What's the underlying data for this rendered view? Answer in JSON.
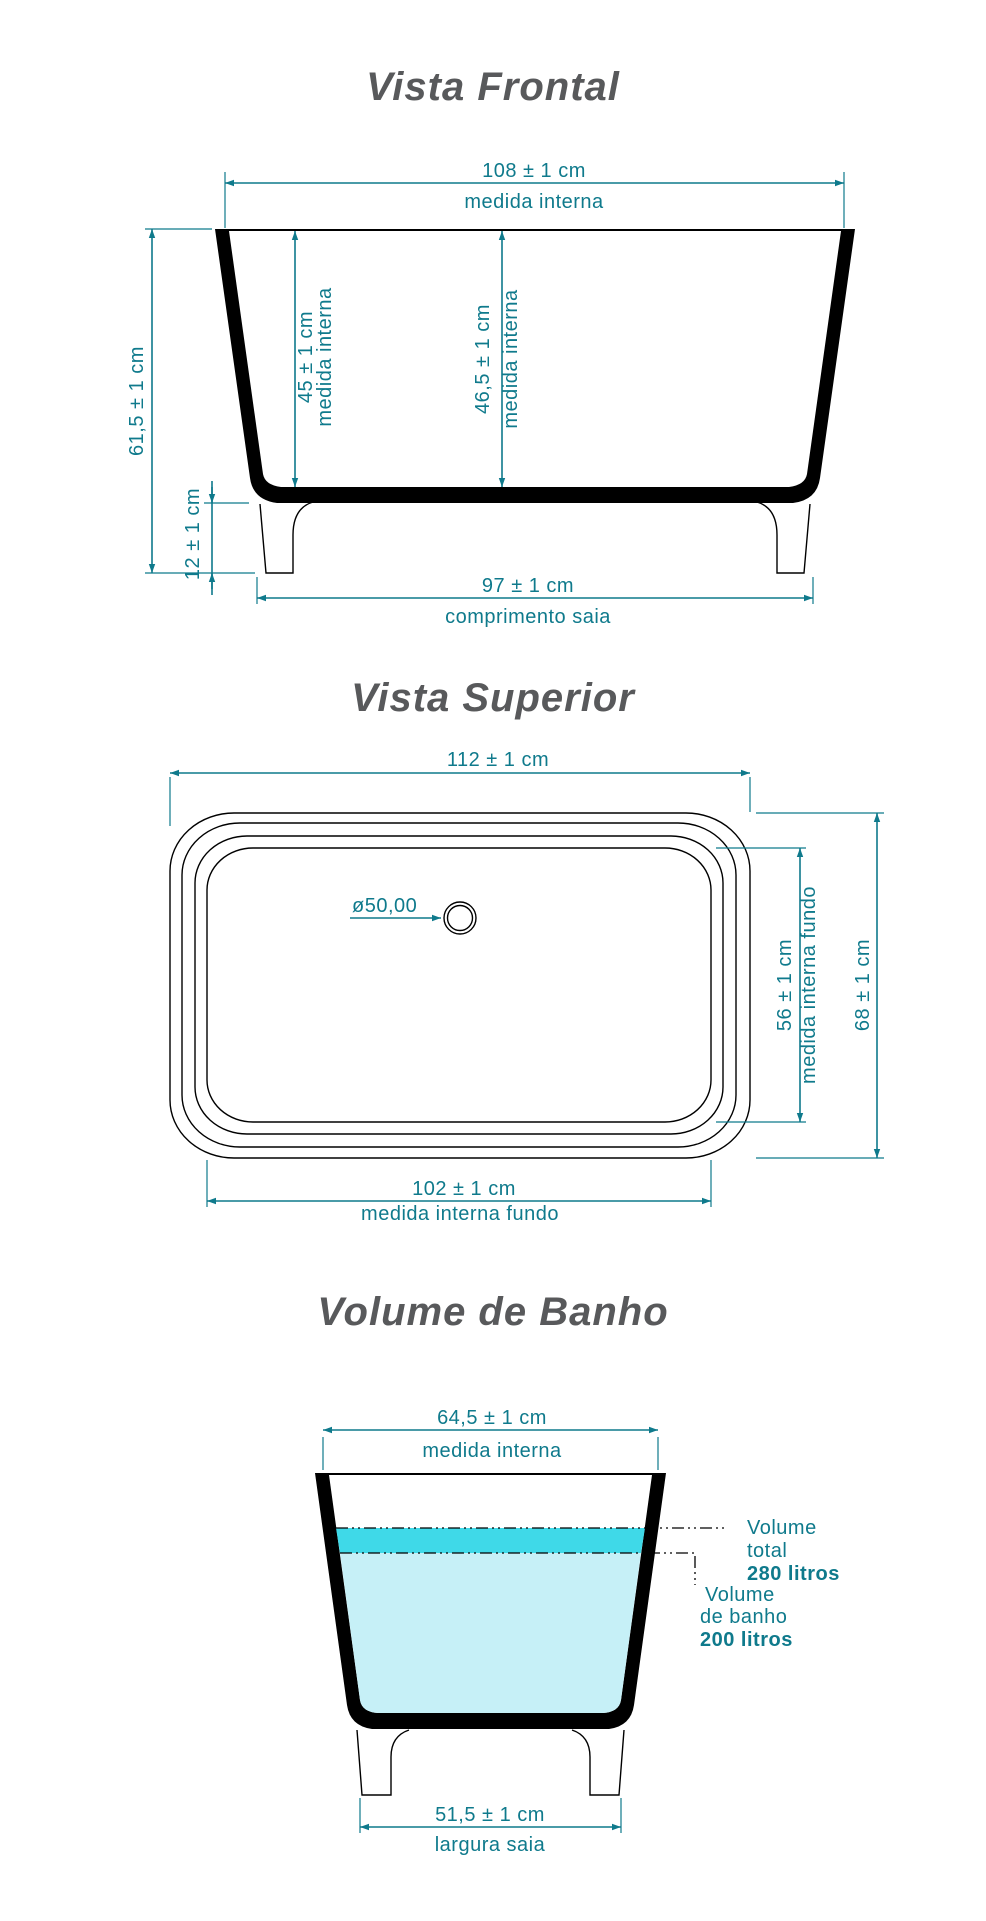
{
  "colors": {
    "accent": "#0F7A8C",
    "title_gray": "#58595B",
    "outline_black": "#000000",
    "water_total": "#3FD9E8",
    "water_bath": "#C6F0F7"
  },
  "frontal": {
    "title": "Vista Frontal",
    "dim_top": {
      "value": "108 ± 1 cm",
      "label": "medida interna"
    },
    "dim_height": "61,5 ± 1 cm",
    "dim_leg_height": "12 ± 1 cm",
    "dim_inner_left": {
      "value": "45 ± 1 cm",
      "label": "medida interna"
    },
    "dim_inner_center": {
      "value": "46,5 ± 1 cm",
      "label": "medida interna"
    },
    "dim_skirt": {
      "value": "97 ± 1 cm",
      "label": "comprimento saia"
    }
  },
  "superior": {
    "title": "Vista Superior",
    "dim_length": "112 ± 1 cm",
    "drain_diameter": "ø50,00",
    "dim_inner_width": {
      "value": "56 ± 1 cm",
      "label": "medida interna fundo"
    },
    "dim_width": "68 ± 1 cm",
    "dim_bottom_length": {
      "value": "102 ± 1 cm",
      "label": "medida interna fundo"
    }
  },
  "volume": {
    "title": "Volume de Banho",
    "dim_top": {
      "value": "64,5 ± 1 cm",
      "label": "medida interna"
    },
    "volume_total": {
      "l1": "Volume",
      "l2": "total",
      "l3": "280 litros"
    },
    "volume_bath": {
      "l1": "Volume",
      "l2": "de banho",
      "l3": "200 litros"
    },
    "dim_skirt": {
      "value": "51,5 ± 1 cm",
      "label": "largura saia"
    }
  }
}
